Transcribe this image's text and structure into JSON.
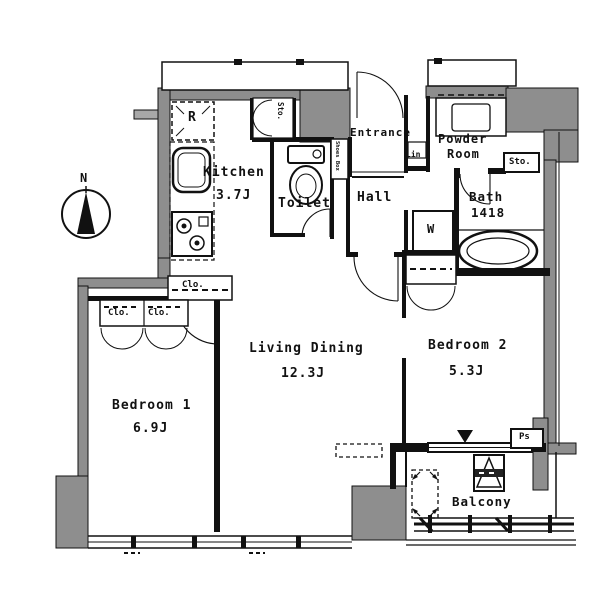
{
  "compass": {
    "north": "N"
  },
  "rooms": {
    "kitchen": {
      "label": "Kitchen",
      "area": "3.7J"
    },
    "toilet": {
      "label": "Toilet"
    },
    "entrance": {
      "label": "Entrance"
    },
    "hall": {
      "label": "Hall"
    },
    "powder_room": {
      "label_line1": "Powder",
      "label_line2": "Room"
    },
    "bath": {
      "label": "Bath",
      "size": "1418"
    },
    "living_dining": {
      "label": "Living Dining",
      "area": "12.3J"
    },
    "bedroom1": {
      "label": "Bedroom 1",
      "area": "6.9J"
    },
    "bedroom2": {
      "label": "Bedroom 2",
      "area": "5.3J"
    },
    "balcony": {
      "label": "Balcony"
    }
  },
  "storage": {
    "kitchen_storage": "Sto.",
    "bath_storage": "Sto.",
    "shoes_box": "Shoes Box",
    "linen": "Lin",
    "closet_living": "Clo.",
    "closet_bedroom1_left": "Clo.",
    "closet_bedroom1_right": "Clo."
  },
  "appliances": {
    "refrigerator": "R",
    "washer": "W"
  },
  "utilities": {
    "pipe_space": "Ps"
  },
  "colors": {
    "wall_fill": "#8e8e8e",
    "line": "#111111",
    "background": "#ffffff"
  }
}
